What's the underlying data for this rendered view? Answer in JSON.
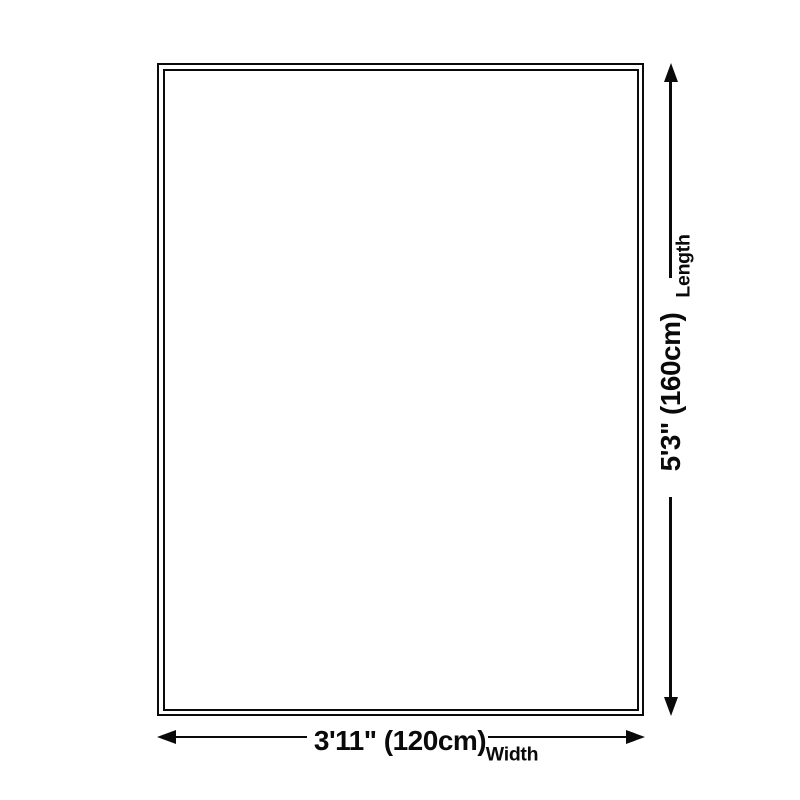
{
  "diagram": {
    "type": "product-dimension-diagram",
    "dimensions": {
      "length": {
        "value": "5'3\" (160cm)",
        "label": "Length"
      },
      "width": {
        "value": "3'11\" (120cm)",
        "label": "Width"
      }
    },
    "colors": {
      "ink": "#0a0a0a",
      "background": "#ffffff"
    }
  }
}
